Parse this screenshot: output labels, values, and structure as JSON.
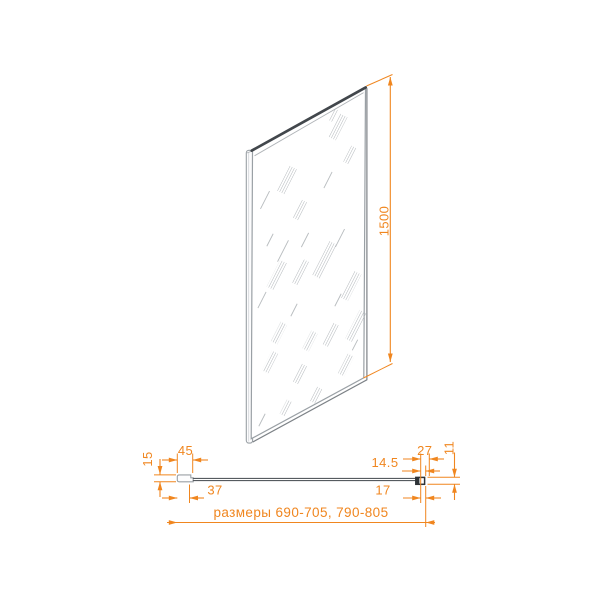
{
  "accent_color": "#F0861F",
  "drawing": {
    "view": "glass-panel-technical-drawing",
    "dims": {
      "d1500": "1500",
      "d45": "45",
      "d15": "15",
      "d37": "37",
      "d27": "27",
      "d14_5": "14.5",
      "d17": "17",
      "d11": "11",
      "overall": "размеры 690-705, 790-805"
    }
  }
}
